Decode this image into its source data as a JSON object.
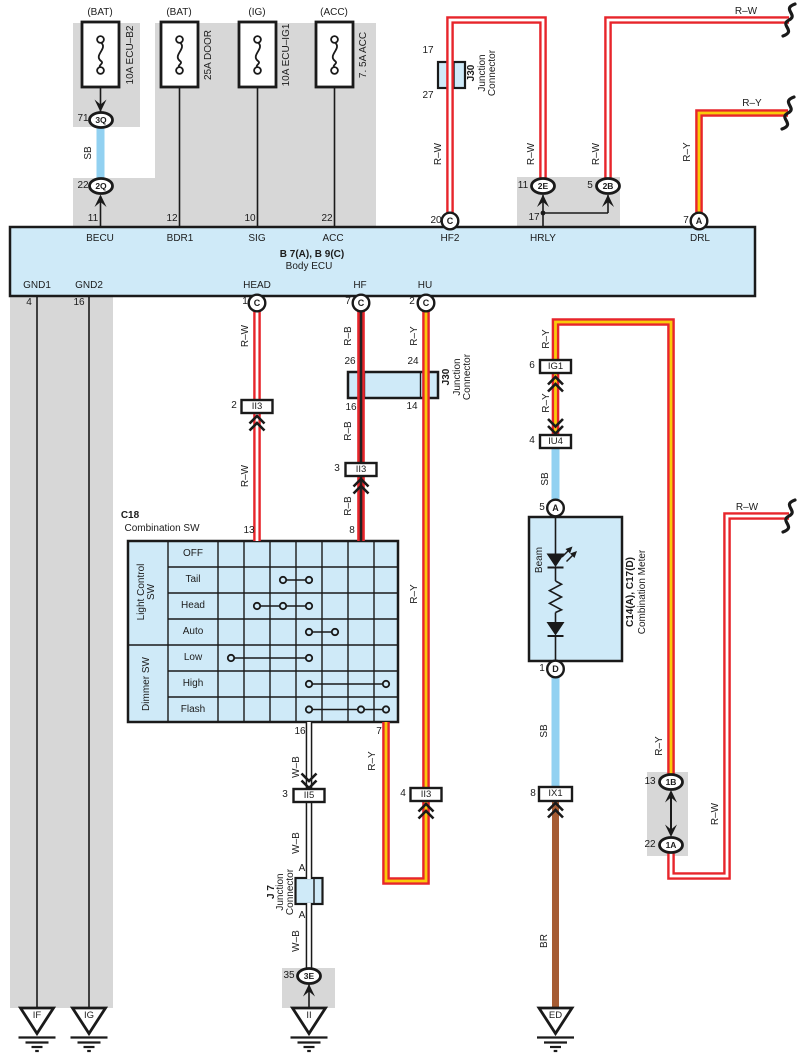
{
  "colors": {
    "wire_red": "#e7252b",
    "wire_yellow_core": "#f9cb0b",
    "wire_white_core": "#ffffff",
    "wire_black_core": "#222222",
    "wire_sky_blue": "#92d1f1",
    "wire_brown": "#a65c33",
    "component_fill_blue": "#cfeaf8",
    "shield_gray": "#d7d7d7",
    "line_black": "#1a1a1a"
  },
  "components": {
    "fuses": [
      {
        "type": "(BAT)",
        "name": "10A ECU–B2"
      },
      {
        "type": "(BAT)",
        "name": "25A DOOR"
      },
      {
        "type": "(IG)",
        "name": "10A ECU–IG1"
      },
      {
        "type": "(ACC)",
        "name": "7. 5A ACC"
      }
    ],
    "body_ecu": {
      "code": "B 7(A), B 9(C)",
      "name": "Body ECU",
      "top_terminals": [
        {
          "pin": "11",
          "terminal": "BECU"
        },
        {
          "pin": "12",
          "terminal": "BDR1"
        },
        {
          "pin": "10",
          "terminal": "SIG"
        },
        {
          "pin": "22",
          "terminal": "ACC"
        },
        {
          "pin": "20",
          "connector": "C",
          "terminal": "HF2"
        },
        {
          "pin": "17",
          "terminal": "HRLY"
        },
        {
          "pin": "7",
          "connector": "A",
          "terminal": "DRL"
        }
      ],
      "bottom_terminals": [
        {
          "pin": "4",
          "terminal": "GND1"
        },
        {
          "pin": "16",
          "terminal": "GND2"
        },
        {
          "pin": "1",
          "connector": "C",
          "terminal": "HEAD"
        },
        {
          "pin": "7",
          "connector": "C",
          "terminal": "HF"
        },
        {
          "pin": "2",
          "connector": "C",
          "terminal": "HU"
        }
      ]
    },
    "junction_connectors": [
      {
        "name": "J30",
        "desc": "Junction Connector",
        "pins": [
          "17",
          "27"
        ]
      },
      {
        "name": "J30",
        "desc": "Junction Connector",
        "pins": [
          "26",
          "24",
          "16",
          "14"
        ]
      },
      {
        "name": "J 7",
        "desc": "Junction Connector",
        "pins": [
          "A",
          "A"
        ]
      }
    ],
    "combination_switch": {
      "code": "C18",
      "name": "Combination SW",
      "groups": [
        {
          "label": "Light Control SW",
          "positions": [
            "OFF",
            "Tail",
            "Head",
            "Auto"
          ]
        },
        {
          "label": "Dimmer SW",
          "positions": [
            "Low",
            "High",
            "Flash"
          ]
        }
      ],
      "top_pins": [
        "13",
        "8"
      ],
      "bottom_pins": [
        "16",
        "7"
      ]
    },
    "combination_meter": {
      "code": "C14(A), C17(D)",
      "name": "Combination Meter",
      "indicator": "Beam",
      "pins": [
        {
          "pin": "5",
          "connector": "A"
        },
        {
          "pin": "1",
          "connector": "D"
        }
      ]
    },
    "inline_connectors": [
      "3Q",
      "2Q",
      "2E",
      "2B",
      "II3",
      "II5",
      "IG1",
      "IU4",
      "IX1",
      "1B",
      "1A",
      "3E"
    ],
    "grounds": [
      "IF",
      "IG",
      "II",
      "ED"
    ],
    "wire_codes": [
      "SB",
      "R–W",
      "R–B",
      "R–Y",
      "W–B",
      "BR"
    ]
  },
  "annotations": [
    {
      "t": "(BAT)",
      "x": 100,
      "y": 13,
      "n": "fuse-type-label"
    },
    {
      "t": "(BAT)",
      "x": 179,
      "y": 13,
      "n": "fuse-type-label"
    },
    {
      "t": "(IG)",
      "x": 257,
      "y": 13,
      "n": "fuse-type-label"
    },
    {
      "t": "(ACC)",
      "x": 334,
      "y": 13,
      "n": "fuse-type-label"
    },
    {
      "t": "10A ECU–B2",
      "x": 131,
      "y": 55,
      "r": 1,
      "n": "fuse-name-label"
    },
    {
      "t": "25A DOOR",
      "x": 209,
      "y": 55,
      "r": 1,
      "n": "fuse-name-label"
    },
    {
      "t": "10A ECU–IG1",
      "x": 287,
      "y": 55,
      "r": 1,
      "n": "fuse-name-label"
    },
    {
      "t": "7. 5A ACC",
      "x": 364,
      "y": 55,
      "r": 1,
      "n": "fuse-name-label"
    },
    {
      "t": "71",
      "x": 83,
      "y": 119,
      "n": "pin-number"
    },
    {
      "t": "3Q",
      "x": 101,
      "y": 120,
      "b": 1,
      "fs": 8.5,
      "n": "connector-code"
    },
    {
      "t": "SB",
      "x": 89,
      "y": 153,
      "r": 1,
      "n": "wire-color-label"
    },
    {
      "t": "22",
      "x": 83,
      "y": 186,
      "n": "pin-number"
    },
    {
      "t": "2Q",
      "x": 101,
      "y": 186,
      "b": 1,
      "fs": 8.5,
      "n": "connector-code"
    },
    {
      "t": "11",
      "x": 93,
      "y": 219,
      "n": "pin-number"
    },
    {
      "t": "12",
      "x": 172,
      "y": 219,
      "n": "pin-number"
    },
    {
      "t": "10",
      "x": 250,
      "y": 219,
      "n": "pin-number"
    },
    {
      "t": "22",
      "x": 327,
      "y": 219,
      "n": "pin-number"
    },
    {
      "t": "17",
      "x": 428,
      "y": 51,
      "n": "pin-number"
    },
    {
      "t": "27",
      "x": 428,
      "y": 96,
      "n": "pin-number"
    },
    {
      "t": "J30",
      "x": 472,
      "y": 73,
      "r": 1,
      "b": 1,
      "n": "component-title"
    },
    {
      "t": "Junction\nConnector",
      "x": 488,
      "y": 73,
      "r": 1,
      "n": "component-title"
    },
    {
      "t": "R–W",
      "x": 439,
      "y": 154,
      "r": 1,
      "n": "wire-color-label"
    },
    {
      "t": "20",
      "x": 436,
      "y": 221,
      "n": "pin-number"
    },
    {
      "t": "C",
      "x": 450,
      "y": 221,
      "b": 1,
      "fs": 9,
      "n": "connector-code"
    },
    {
      "t": "R–W",
      "x": 532,
      "y": 154,
      "r": 1,
      "n": "wire-color-label"
    },
    {
      "t": "R–W",
      "x": 597,
      "y": 154,
      "r": 1,
      "n": "wire-color-label"
    },
    {
      "t": "11",
      "x": 523,
      "y": 186,
      "n": "pin-number"
    },
    {
      "t": "2E",
      "x": 543,
      "y": 186,
      "b": 1,
      "fs": 8.5,
      "n": "connector-code"
    },
    {
      "t": "5",
      "x": 590,
      "y": 186,
      "n": "pin-number"
    },
    {
      "t": "2B",
      "x": 608,
      "y": 186,
      "b": 1,
      "fs": 8.5,
      "n": "connector-code"
    },
    {
      "t": "17",
      "x": 534,
      "y": 218,
      "n": "pin-number"
    },
    {
      "t": "R–Y",
      "x": 688,
      "y": 152,
      "r": 1,
      "n": "wire-color-label"
    },
    {
      "t": "7",
      "x": 686,
      "y": 221,
      "n": "pin-number"
    },
    {
      "t": "A",
      "x": 699,
      "y": 221,
      "b": 1,
      "fs": 9,
      "n": "connector-code"
    },
    {
      "t": "R–W",
      "x": 746,
      "y": 12,
      "n": "wire-color-label"
    },
    {
      "t": "R–Y",
      "x": 752,
      "y": 104,
      "n": "wire-color-label"
    },
    {
      "t": "BECU",
      "x": 100,
      "y": 239,
      "n": "terminal-label"
    },
    {
      "t": "BDR1",
      "x": 180,
      "y": 239,
      "n": "terminal-label"
    },
    {
      "t": "SIG",
      "x": 257,
      "y": 239,
      "n": "terminal-label"
    },
    {
      "t": "ACC",
      "x": 333,
      "y": 239,
      "n": "terminal-label"
    },
    {
      "t": "HF2",
      "x": 450,
      "y": 239,
      "n": "terminal-label"
    },
    {
      "t": "HRLY",
      "x": 543,
      "y": 239,
      "n": "terminal-label"
    },
    {
      "t": "DRL",
      "x": 700,
      "y": 239,
      "n": "terminal-label"
    },
    {
      "t": "B 7(A), B 9(C)",
      "x": 312,
      "y": 255,
      "b": 1,
      "n": "component-title"
    },
    {
      "t": "Body ECU",
      "x": 309,
      "y": 267,
      "n": "component-title"
    },
    {
      "t": "GND1",
      "x": 37,
      "y": 286,
      "n": "terminal-label"
    },
    {
      "t": "GND2",
      "x": 89,
      "y": 286,
      "n": "terminal-label"
    },
    {
      "t": "HEAD",
      "x": 257,
      "y": 286,
      "n": "terminal-label"
    },
    {
      "t": "HF",
      "x": 360,
      "y": 286,
      "n": "terminal-label"
    },
    {
      "t": "HU",
      "x": 425,
      "y": 286,
      "n": "terminal-label"
    },
    {
      "t": "4",
      "x": 29,
      "y": 303,
      "n": "pin-number"
    },
    {
      "t": "16",
      "x": 79,
      "y": 303,
      "n": "pin-number"
    },
    {
      "t": "1",
      "x": 245,
      "y": 302,
      "n": "pin-number"
    },
    {
      "t": "C",
      "x": 257,
      "y": 303,
      "b": 1,
      "fs": 9,
      "n": "connector-code"
    },
    {
      "t": "7",
      "x": 348,
      "y": 302,
      "n": "pin-number"
    },
    {
      "t": "C",
      "x": 361,
      "y": 303,
      "b": 1,
      "fs": 9,
      "n": "connector-code"
    },
    {
      "t": "2",
      "x": 412,
      "y": 302,
      "n": "pin-number"
    },
    {
      "t": "C",
      "x": 426,
      "y": 303,
      "b": 1,
      "fs": 9,
      "n": "connector-code"
    },
    {
      "t": "R–W",
      "x": 246,
      "y": 336,
      "r": 1,
      "n": "wire-color-label"
    },
    {
      "t": "R–B",
      "x": 349,
      "y": 336,
      "r": 1,
      "n": "wire-color-label"
    },
    {
      "t": "R–Y",
      "x": 415,
      "y": 336,
      "r": 1,
      "n": "wire-color-label"
    },
    {
      "t": "26",
      "x": 350,
      "y": 362,
      "n": "pin-number"
    },
    {
      "t": "24",
      "x": 413,
      "y": 362,
      "n": "pin-number"
    },
    {
      "t": "16",
      "x": 351,
      "y": 408,
      "n": "pin-number"
    },
    {
      "t": "14",
      "x": 412,
      "y": 407,
      "n": "pin-number"
    },
    {
      "t": "J30",
      "x": 447,
      "y": 377,
      "r": 1,
      "b": 1,
      "n": "component-title"
    },
    {
      "t": "Junction\nConnector",
      "x": 463,
      "y": 377,
      "r": 1,
      "n": "component-title"
    },
    {
      "t": "2",
      "x": 234,
      "y": 406,
      "n": "pin-number"
    },
    {
      "t": "II3",
      "x": 257,
      "y": 406.5,
      "fs": 9.5,
      "n": "connector-code"
    },
    {
      "t": "R–W",
      "x": 246,
      "y": 476,
      "r": 1,
      "n": "wire-color-label"
    },
    {
      "t": "R–B",
      "x": 349,
      "y": 431,
      "r": 1,
      "n": "wire-color-label"
    },
    {
      "t": "3",
      "x": 337,
      "y": 469,
      "n": "pin-number"
    },
    {
      "t": "II3",
      "x": 361,
      "y": 469.5,
      "fs": 9.5,
      "n": "connector-code"
    },
    {
      "t": "R–B",
      "x": 349,
      "y": 506,
      "r": 1,
      "n": "wire-color-label"
    },
    {
      "t": "R–Y",
      "x": 415,
      "y": 594,
      "r": 1,
      "n": "wire-color-label"
    },
    {
      "t": "C18",
      "x": 130,
      "y": 516,
      "b": 1,
      "n": "component-title"
    },
    {
      "t": "Combination SW",
      "x": 162,
      "y": 529,
      "n": "component-title"
    },
    {
      "t": "13",
      "x": 249,
      "y": 531,
      "n": "pin-number"
    },
    {
      "t": "8",
      "x": 352,
      "y": 531,
      "n": "pin-number"
    },
    {
      "t": "OFF",
      "x": 193,
      "y": 554,
      "n": "switch-position-label"
    },
    {
      "t": "Tail",
      "x": 193,
      "y": 580,
      "n": "switch-position-label"
    },
    {
      "t": "Head",
      "x": 193,
      "y": 606,
      "n": "switch-position-label"
    },
    {
      "t": "Auto",
      "x": 193,
      "y": 632,
      "n": "switch-position-label"
    },
    {
      "t": "Low",
      "x": 193,
      "y": 658,
      "n": "switch-position-label"
    },
    {
      "t": "High",
      "x": 193,
      "y": 684,
      "n": "switch-position-label"
    },
    {
      "t": "Flash",
      "x": 193,
      "y": 710,
      "n": "switch-position-label"
    },
    {
      "t": "Light Control\nSW",
      "x": 147,
      "y": 592,
      "r": 1,
      "n": "switch-group-label"
    },
    {
      "t": "Dimmer SW",
      "x": 147,
      "y": 684,
      "r": 1,
      "n": "switch-group-label"
    },
    {
      "t": "16",
      "x": 300,
      "y": 732,
      "n": "pin-number"
    },
    {
      "t": "7",
      "x": 379,
      "y": 732,
      "n": "pin-number"
    },
    {
      "t": "W–B",
      "x": 296.5,
      "y": 767,
      "r": 1,
      "n": "wire-color-label"
    },
    {
      "t": "R–Y",
      "x": 373,
      "y": 761,
      "r": 1,
      "n": "wire-color-label"
    },
    {
      "t": "3",
      "x": 285,
      "y": 795,
      "n": "pin-number"
    },
    {
      "t": "II5",
      "x": 309,
      "y": 795.5,
      "fs": 9.5,
      "n": "connector-code"
    },
    {
      "t": "4",
      "x": 403,
      "y": 794,
      "n": "pin-number"
    },
    {
      "t": "II3",
      "x": 426,
      "y": 794.5,
      "fs": 9.5,
      "n": "connector-code"
    },
    {
      "t": "W–B",
      "x": 296.5,
      "y": 843,
      "r": 1,
      "n": "wire-color-label"
    },
    {
      "t": "A",
      "x": 302,
      "y": 869,
      "n": "pin-number"
    },
    {
      "t": "J 7",
      "x": 272,
      "y": 892,
      "r": 1,
      "b": 1,
      "n": "component-title"
    },
    {
      "t": "Junction\nConnector",
      "x": 286,
      "y": 892,
      "r": 1,
      "n": "component-title"
    },
    {
      "t": "A",
      "x": 302,
      "y": 916,
      "n": "pin-number"
    },
    {
      "t": "W–B",
      "x": 296.5,
      "y": 941,
      "r": 1,
      "n": "wire-color-label"
    },
    {
      "t": "35",
      "x": 289,
      "y": 976,
      "n": "pin-number"
    },
    {
      "t": "3E",
      "x": 309,
      "y": 976,
      "b": 1,
      "fs": 8.5,
      "n": "connector-code"
    },
    {
      "t": "IF",
      "x": 37,
      "y": 1016,
      "fs": 9.5,
      "n": "ground-code"
    },
    {
      "t": "IG",
      "x": 89,
      "y": 1016,
      "fs": 9.5,
      "n": "ground-code"
    },
    {
      "t": "II",
      "x": 309,
      "y": 1016,
      "fs": 9.5,
      "n": "ground-code"
    },
    {
      "t": "R–Y",
      "x": 547,
      "y": 339,
      "r": 1,
      "n": "wire-color-label"
    },
    {
      "t": "6",
      "x": 532,
      "y": 366,
      "n": "pin-number"
    },
    {
      "t": "IG1",
      "x": 555.5,
      "y": 366.5,
      "fs": 9.5,
      "n": "connector-code"
    },
    {
      "t": "R–Y",
      "x": 547,
      "y": 403,
      "r": 1,
      "n": "wire-color-label"
    },
    {
      "t": "4",
      "x": 532,
      "y": 441,
      "n": "pin-number"
    },
    {
      "t": "IU4",
      "x": 555.5,
      "y": 441.5,
      "fs": 9.5,
      "n": "connector-code"
    },
    {
      "t": "SB",
      "x": 546,
      "y": 479,
      "r": 1,
      "n": "wire-color-label"
    },
    {
      "t": "5",
      "x": 542,
      "y": 508,
      "n": "pin-number"
    },
    {
      "t": "A",
      "x": 555.5,
      "y": 508,
      "b": 1,
      "fs": 9,
      "n": "connector-code"
    },
    {
      "t": "Beam",
      "x": 540,
      "y": 560,
      "r": 1,
      "n": "indicator-label"
    },
    {
      "t": "C14(A), C17(D)",
      "x": 631,
      "y": 592,
      "r": 1,
      "b": 1,
      "n": "component-title"
    },
    {
      "t": "Combination Meter",
      "x": 643,
      "y": 592,
      "r": 1,
      "n": "component-title"
    },
    {
      "t": "1",
      "x": 542,
      "y": 669,
      "n": "pin-number"
    },
    {
      "t": "D",
      "x": 555.5,
      "y": 669,
      "b": 1,
      "fs": 9,
      "n": "connector-code"
    },
    {
      "t": "SB",
      "x": 545,
      "y": 731,
      "r": 1,
      "n": "wire-color-label"
    },
    {
      "t": "8",
      "x": 533,
      "y": 794,
      "n": "pin-number"
    },
    {
      "t": "IX1",
      "x": 555.5,
      "y": 794,
      "fs": 9.5,
      "n": "connector-code"
    },
    {
      "t": "BR",
      "x": 545,
      "y": 941,
      "r": 1,
      "n": "wire-color-label"
    },
    {
      "t": "ED",
      "x": 555.5,
      "y": 1016,
      "fs": 9.5,
      "n": "ground-code"
    },
    {
      "t": "R–Y",
      "x": 660,
      "y": 746,
      "r": 1,
      "n": "wire-color-label"
    },
    {
      "t": "13",
      "x": 650,
      "y": 782,
      "n": "pin-number"
    },
    {
      "t": "1B",
      "x": 671,
      "y": 782,
      "b": 1,
      "fs": 8.5,
      "n": "connector-code"
    },
    {
      "t": "22",
      "x": 650,
      "y": 845,
      "n": "pin-number"
    },
    {
      "t": "1A",
      "x": 671,
      "y": 845,
      "b": 1,
      "fs": 8.5,
      "n": "connector-code"
    },
    {
      "t": "R–W",
      "x": 716,
      "y": 814,
      "r": 1,
      "n": "wire-color-label"
    },
    {
      "t": "R–W",
      "x": 747,
      "y": 508,
      "n": "wire-color-label"
    }
  ]
}
